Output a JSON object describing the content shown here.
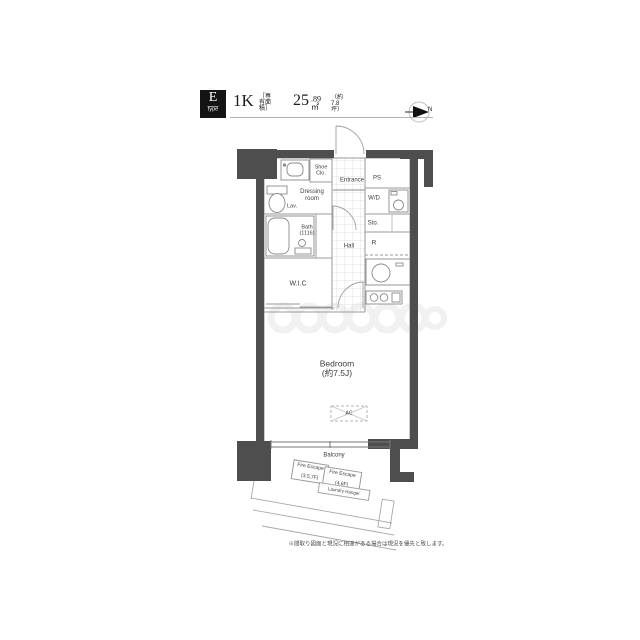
{
  "header": {
    "type_letter": "E",
    "type_word": "type",
    "layout": "1K",
    "area_label": "［専有面積］",
    "area_int": "25",
    "area_frac": ".89㎡",
    "area_tsubo": "（約7.8坪）",
    "compass": "N"
  },
  "plan": {
    "labels": {
      "shoe_closet": "Shoe Clo.",
      "entrance": "Entrance",
      "ps": "PS",
      "dressing_room": "Dressing room",
      "lavatory": "Lav.",
      "washer_dryer": "W/D",
      "bath": "Bath",
      "bath_size": "(1116)",
      "storage": "Sto.",
      "hall": "Hall",
      "refrigerator": "R",
      "walk_in_closet": "W.I.C",
      "bedroom": "Bedroom",
      "bedroom_size": "(約7.5J)",
      "air_conditioner": "AC",
      "balcony": "Balcony",
      "fire_escape_a_line1": "Fire Escape",
      "fire_escape_a_line2": "(3,5,7F)",
      "fire_escape_b_line1": "Fire Escape",
      "fire_escape_b_line2": "(4,6F)",
      "laundry_hanger": "Laundry Hanger"
    }
  },
  "footnote": "※間取り図面と現況に相違がある場合は現況を優先と致します。",
  "colors": {
    "wall": "#4e4e4e",
    "line": "#9a9a9a",
    "badge": "#141414"
  }
}
